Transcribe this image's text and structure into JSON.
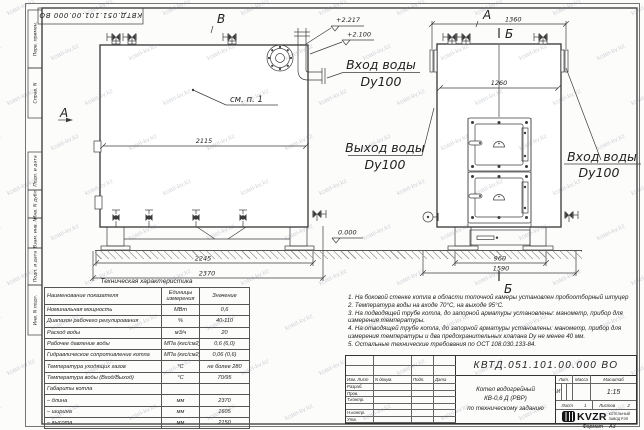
{
  "watermark": {
    "text": "kotel-kv.kz"
  },
  "stamp_top": {
    "text": "КВТД.051.101.00.000 ВО"
  },
  "margin": {
    "top": [
      "Перв. примен.",
      "Справ. N"
    ],
    "bottom": [
      "Подп. и дата",
      "Инв. N дубл.",
      "Взам. инв. N",
      "Подп. и дата",
      "Инв. N подл."
    ]
  },
  "side_view": {
    "view_marker": "В",
    "section_marker": "А",
    "note_ref": "см. п. 1",
    "dims": {
      "inner_length": "2115",
      "frame_length": "2245",
      "overall_length": "2370"
    },
    "elevations": {
      "top": "+2.217",
      "inlet": "+2.100",
      "ground": "0.000"
    },
    "inlet_label": [
      "Вход воды",
      "Dy100"
    ],
    "outlet_label": [
      "Выход воды",
      "Dy100"
    ]
  },
  "front_view": {
    "view_marker": "А",
    "section_top": "Б",
    "section_bottom": "Б",
    "dims": {
      "top_width": "1360",
      "inner_width": "1260",
      "base_width": "960",
      "overall_width": "1590"
    },
    "inlet_label": [
      "Вход воды",
      "Dy100"
    ]
  },
  "tech_table": {
    "title": "Техническая характеристика",
    "headers": [
      "Наименование показателя",
      "Единицы измерения",
      "Значение"
    ],
    "rows": [
      {
        "name": "Номинальная мощность",
        "unit": "МВт",
        "value": "0,6"
      },
      {
        "name": "Диапазон рабочего регулирования",
        "unit": "%",
        "value": "40-110"
      },
      {
        "name": "Расход воды",
        "unit": "м3/ч",
        "value": "20"
      },
      {
        "name": "Рабочее давление воды",
        "unit": "МПа (кгс/см2)",
        "value": "0,6 (6,0)"
      },
      {
        "name": "Гидравлическое сопротивление котла",
        "unit": "МПа (кгс/см2)",
        "value": "0,06 (0,6)"
      },
      {
        "name": "Температура уходящих газов",
        "unit": "°С",
        "value": "не более 280"
      },
      {
        "name": "Температура воды (Вход/Выход)",
        "unit": "°С",
        "value": "70/95"
      },
      {
        "name": "Габариты котла",
        "unit": "",
        "value": ""
      },
      {
        "name": "– длина",
        "unit": "мм",
        "value": "2370"
      },
      {
        "name": "– ширина",
        "unit": "мм",
        "value": "1605"
      },
      {
        "name": "– высота",
        "unit": "мм",
        "value": "2150"
      }
    ]
  },
  "notes": [
    "1. На боковой стенке котла в области топочной камеры установлен пробоотборный штуцер",
    "2. Температура воды на входе 70°С, на выходе 95°С.",
    "3. На подводящей трубе котла, до запорной арматуры установлены: манометр, прибор для измерения температуры.",
    "4. На отводящей трубе котла, до запорной арматуры установлены: манометр, прибор для измерения температуры и два предохранительных клапана Dу не менее 40 мм.",
    "5. Остальные технические требования по ОСТ 108.030.133-84."
  ],
  "title_block": {
    "doc_number": "КВТД.051.101.00.000 ВО",
    "change_cols": [
      "Изм. Лист",
      "N докум.",
      "Подп.",
      "Дата"
    ],
    "sign_rows": [
      "Разраб.",
      "Пров.",
      "Т.контр.",
      "",
      "Н.контр.",
      "Утв."
    ],
    "title_lines": [
      "Котел водогрейный",
      "КВ-0,6 Д (РВР)",
      "по техническому заданию"
    ],
    "lit_headers": [
      "Лит.",
      "Масса",
      "Масштаб"
    ],
    "lit_value": "И",
    "scale": "1:15",
    "sheet_label": "Лист",
    "sheet_value": "1",
    "sheets_label": "Листов",
    "sheets_value": "2",
    "logo_text": "KVZR",
    "logo_caption": [
      "КОТЕЛЬНЫЙ",
      "ЗАВОД РЭП"
    ],
    "format_label": "Формат",
    "format_value": "А3"
  }
}
